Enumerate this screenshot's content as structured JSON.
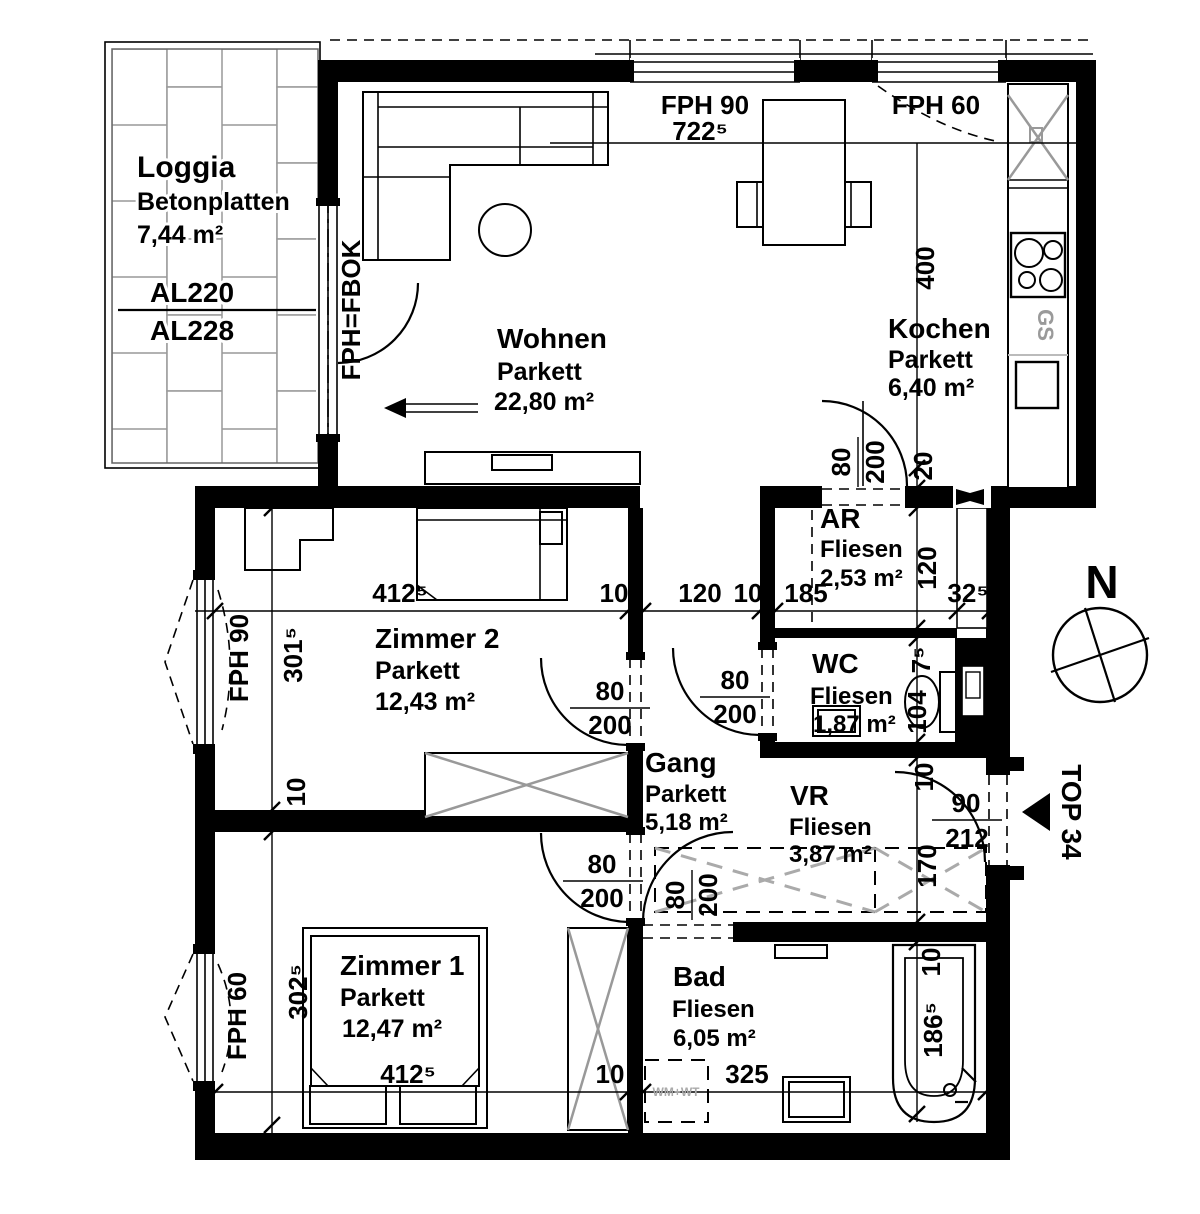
{
  "unit_label": "TOP 34",
  "compass_north": "N",
  "rooms": {
    "loggia": {
      "name": "Loggia",
      "floor": "Betonplatten",
      "area": "7,44 m²"
    },
    "wohnen": {
      "name": "Wohnen",
      "floor": "Parkett",
      "area": "22,80 m²"
    },
    "kochen": {
      "name": "Kochen",
      "floor": "Parkett",
      "area": "6,40 m²"
    },
    "ar": {
      "name": "AR",
      "floor": "Fliesen",
      "area": "2,53 m²"
    },
    "wc": {
      "name": "WC",
      "floor": "Fliesen",
      "area": "1,87 m²"
    },
    "gang": {
      "name": "Gang",
      "floor": "Parkett",
      "area": "5,18 m²"
    },
    "vr": {
      "name": "VR",
      "floor": "Fliesen",
      "area": "3,87 m²"
    },
    "zimmer2": {
      "name": "Zimmer 2",
      "floor": "Parkett",
      "area": "12,43 m²"
    },
    "zimmer1": {
      "name": "Zimmer 1",
      "floor": "Parkett",
      "area": "12,47 m²"
    },
    "bad": {
      "name": "Bad",
      "floor": "Fliesen",
      "area": "6,05 m²"
    }
  },
  "loggia_levels": {
    "upper": "AL220",
    "lower": "AL228"
  },
  "windows": {
    "top_90": "FPH 90",
    "top_60": "FPH 60",
    "left_90": "FPH 90",
    "left_60": "FPH 60",
    "balcony_door": "FPH=FBOK"
  },
  "door_labels": {
    "interior_width": "80",
    "interior_height": "200",
    "entry_width": "90",
    "entry_height": "212"
  },
  "appliances": {
    "dishwasher": "GS",
    "washer_dryer": "WM+WT"
  },
  "dimensions": {
    "top_total": "722⁵",
    "kitchen_length": "400",
    "kitchen_offset": "20",
    "ar_length": "120",
    "wall_7_5": "7⁵",
    "wc_length": "104",
    "wall_10_right": "10",
    "vr_length": "170",
    "bath_offset": "10",
    "tub_length": "186⁵",
    "zimmer2_width": "412⁵",
    "wall_10_mid": "10",
    "gang_opening": "120",
    "wall_10_mid2": "10",
    "ar_width": "185",
    "shaft_width": "32⁵",
    "zimmer2_length": "301⁵",
    "wall_10_left": "10",
    "zimmer1_length": "302⁵",
    "zimmer1_width": "412⁵",
    "wall_10_bottom": "10",
    "bad_width": "325"
  },
  "colors": {
    "wall": "#000000",
    "furniture_accent": "#999999",
    "tile_line": "#aaaaaa"
  }
}
